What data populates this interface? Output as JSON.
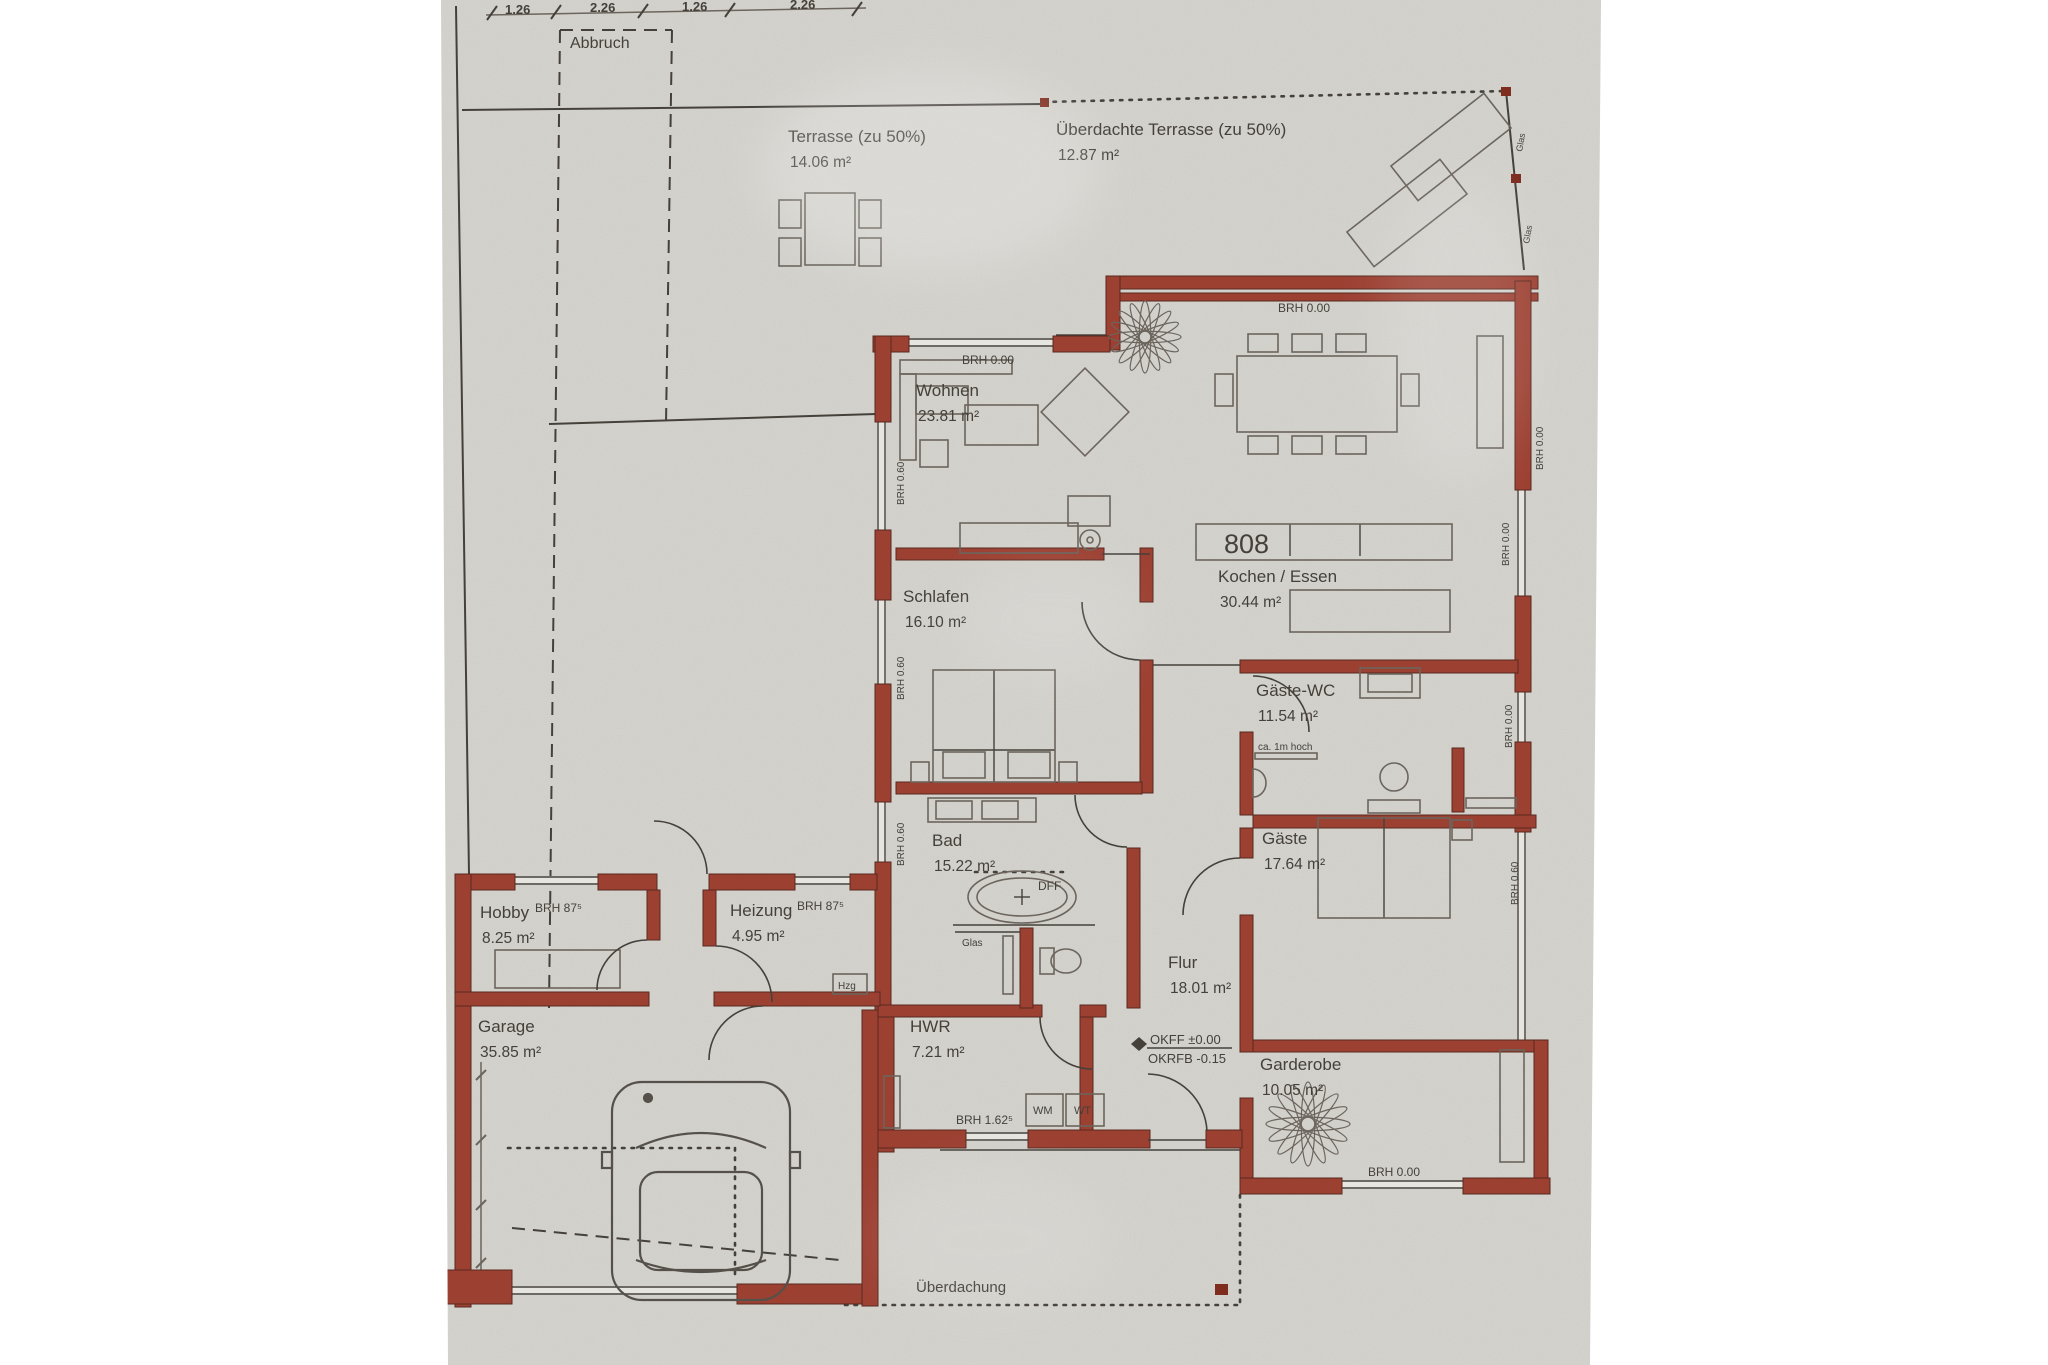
{
  "palette": {
    "paper": "#d4d2cc",
    "paper_light": "#e7e5e0",
    "wall_red": "#9c4032",
    "wall_stroke": "#58291f",
    "ink": "#45403a",
    "ink_soft": "#6b655d",
    "marker_red": "#7e2d1f",
    "white": "#ffffff"
  },
  "canvas": {
    "w": 2048,
    "h": 1365,
    "paper_poly": "441,0 1601,0 1590,1365 448,1365"
  },
  "dims": {
    "line": [
      486,
      15,
      866,
      8
    ],
    "ticks": [
      [
        492,
        13
      ],
      [
        556,
        12
      ],
      [
        643,
        11
      ],
      [
        730,
        10
      ],
      [
        857,
        9
      ]
    ],
    "labels": [
      {
        "t": "1.26",
        "x": 505,
        "y": 14
      },
      {
        "t": "2.26",
        "x": 590,
        "y": 12
      },
      {
        "t": "1.26",
        "x": 682,
        "y": 11
      },
      {
        "t": "2.26",
        "x": 790,
        "y": 9
      }
    ]
  },
  "rooms": [
    {
      "name": "terrasse",
      "label": "Terrasse (zu 50%)",
      "area": "14.06 m²",
      "x": 788,
      "y": 142
    },
    {
      "name": "ueberdachte-terrasse",
      "label": "Überdachte Terrasse (zu 50%)",
      "area": "12.87 m²",
      "x": 1056,
      "y": 135
    },
    {
      "name": "wohnen",
      "label": "Wohnen",
      "area": "23.81 m²",
      "x": 916,
      "y": 396
    },
    {
      "name": "kochen-essen",
      "label": "Kochen / Essen",
      "area": "30.44 m²",
      "x": 1218,
      "y": 582
    },
    {
      "name": "schlafen",
      "label": "Schlafen",
      "area": "16.10 m²",
      "x": 903,
      "y": 602
    },
    {
      "name": "gaeste-wc",
      "label": "Gäste-WC",
      "area": "11.54 m²",
      "x": 1256,
      "y": 696
    },
    {
      "name": "bad",
      "label": "Bad",
      "area": "15.22 m²",
      "x": 932,
      "y": 846
    },
    {
      "name": "gaeste",
      "label": "Gäste",
      "area": "17.64 m²",
      "x": 1262,
      "y": 844
    },
    {
      "name": "flur",
      "label": "Flur",
      "area": "18.01 m²",
      "x": 1168,
      "y": 968
    },
    {
      "name": "hobby",
      "label": "Hobby",
      "area": "8.25 m²",
      "x": 480,
      "y": 918
    },
    {
      "name": "heizung",
      "label": "Heizung",
      "area": "4.95 m²",
      "x": 730,
      "y": 916
    },
    {
      "name": "garage",
      "label": "Garage",
      "area": "35.85 m²",
      "x": 478,
      "y": 1032
    },
    {
      "name": "hwr",
      "label": "HWR",
      "area": "7.21 m²",
      "x": 910,
      "y": 1032
    },
    {
      "name": "garderobe",
      "label": "Garderobe",
      "area": "10.05 m²",
      "x": 1260,
      "y": 1070
    }
  ],
  "annotations": [
    {
      "t": "Abbruch",
      "x": 570,
      "y": 48,
      "fs": 16
    },
    {
      "t": "BRH 0.00",
      "x": 962,
      "y": 364,
      "fs": 12
    },
    {
      "t": "BRH 0.00",
      "x": 1278,
      "y": 312,
      "fs": 12
    },
    {
      "t": "BRH 87⁵",
      "x": 535,
      "y": 912,
      "fs": 12
    },
    {
      "t": "BRH 87⁵",
      "x": 797,
      "y": 910,
      "fs": 12
    },
    {
      "t": "ca. 1m hoch",
      "x": 1258,
      "y": 750,
      "fs": 10
    },
    {
      "t": "DFF",
      "x": 1038,
      "y": 890,
      "fs": 12
    },
    {
      "t": "Glas",
      "x": 962,
      "y": 946,
      "fs": 10
    },
    {
      "t": "OKFF  ±0.00",
      "x": 1150,
      "y": 1044,
      "fs": 13
    },
    {
      "t": "OKRFB -0.15",
      "x": 1148,
      "y": 1063,
      "fs": 13
    },
    {
      "t": "Hzg",
      "x": 838,
      "y": 989,
      "fs": 10
    },
    {
      "t": "WM",
      "x": 1033,
      "y": 1114,
      "fs": 11
    },
    {
      "t": "WT",
      "x": 1074,
      "y": 1114,
      "fs": 11
    },
    {
      "t": "BRH 1.62⁵",
      "x": 956,
      "y": 1124,
      "fs": 12
    },
    {
      "t": "BRH 0.00",
      "x": 1368,
      "y": 1176,
      "fs": 12
    },
    {
      "t": "Überdachung",
      "x": 916,
      "y": 1292,
      "fs": 15
    },
    {
      "t": "808",
      "x": 1224,
      "y": 553,
      "fs": 27
    },
    {
      "t": "BRH 0.60",
      "x": 904,
      "y": 505,
      "fs": 10,
      "rot": -90
    },
    {
      "t": "BRH 0.60",
      "x": 904,
      "y": 700,
      "fs": 10,
      "rot": -90
    },
    {
      "t": "BRH 0.60",
      "x": 904,
      "y": 866,
      "fs": 10,
      "rot": -90
    },
    {
      "t": "BRH 0.00",
      "x": 1509,
      "y": 566,
      "fs": 10,
      "rot": -90
    },
    {
      "t": "BRH 0.00",
      "x": 1543,
      "y": 470,
      "fs": 10,
      "rot": -90
    },
    {
      "t": "BRH 0.00",
      "x": 1512,
      "y": 748,
      "fs": 10,
      "rot": -90
    },
    {
      "t": "BRH 0.60",
      "x": 1518,
      "y": 905,
      "fs": 10,
      "rot": -90
    },
    {
      "t": "Glas",
      "x": 1522,
      "y": 152,
      "fs": 9,
      "rot": -80
    },
    {
      "t": "Glas",
      "x": 1529,
      "y": 244,
      "fs": 9,
      "rot": -80
    }
  ],
  "site": {
    "solid": [
      [
        462,
        110,
        1044,
        104
      ],
      [
        1506,
        91,
        1524,
        270
      ],
      [
        456,
        6,
        469,
        874
      ],
      [
        549,
        424,
        876,
        414
      ]
    ],
    "dashed": [
      [
        560,
        30,
        672,
        30
      ],
      [
        560,
        30,
        549,
        1008
      ],
      [
        672,
        30,
        666,
        424
      ],
      [
        512,
        1228,
        840,
        1260
      ]
    ],
    "dotted": [
      [
        1044,
        102,
        1506,
        91
      ],
      [
        1240,
        1195,
        1240,
        1307
      ],
      [
        845,
        1305,
        1240,
        1305
      ],
      [
        508,
        1148,
        735,
        1148
      ],
      [
        735,
        1148,
        735,
        1277
      ],
      [
        975,
        872,
        1070,
        872
      ]
    ],
    "markers": [
      [
        1040,
        98,
        9,
        9
      ],
      [
        1501,
        87,
        10,
        9
      ],
      [
        1511,
        174,
        10,
        9
      ],
      [
        1215,
        1284,
        13,
        11
      ]
    ],
    "chain": {
      "line": [
        481,
        1062,
        481,
        1272
      ],
      "ticks": [
        [
          476,
          1080,
          486,
          1070
        ],
        [
          476,
          1145,
          486,
          1135
        ],
        [
          476,
          1210,
          486,
          1200
        ],
        [
          476,
          1268,
          486,
          1258
        ]
      ]
    }
  },
  "walls": [
    [
      1118,
      276,
      420,
      13
    ],
    [
      1118,
      293,
      420,
      8
    ],
    [
      1106,
      276,
      14,
      74
    ],
    [
      873,
      336,
      36,
      16
    ],
    [
      1053,
      336,
      57,
      16
    ],
    [
      875,
      336,
      16,
      86
    ],
    [
      875,
      530,
      16,
      70
    ],
    [
      875,
      684,
      16,
      118
    ],
    [
      875,
      862,
      16,
      150
    ],
    [
      878,
      1010,
      16,
      142
    ],
    [
      1515,
      281,
      16,
      209
    ],
    [
      1515,
      596,
      16,
      96
    ],
    [
      1515,
      742,
      16,
      90
    ],
    [
      1253,
      1040,
      295,
      12
    ],
    [
      1534,
      1040,
      14,
      152
    ],
    [
      1240,
      1178,
      102,
      16
    ],
    [
      1463,
      1178,
      87,
      16
    ],
    [
      896,
      548,
      208,
      12
    ],
    [
      1140,
      548,
      13,
      54
    ],
    [
      1140,
      660,
      13,
      133
    ],
    [
      896,
      782,
      246,
      12
    ],
    [
      1127,
      848,
      13,
      160
    ],
    [
      878,
      1005,
      164,
      12
    ],
    [
      1080,
      1005,
      26,
      12
    ],
    [
      1080,
      1017,
      13,
      113
    ],
    [
      1240,
      660,
      278,
      13
    ],
    [
      1240,
      732,
      13,
      83
    ],
    [
      1253,
      815,
      283,
      13
    ],
    [
      1240,
      828,
      13,
      30
    ],
    [
      1240,
      915,
      13,
      137
    ],
    [
      1240,
      1098,
      13,
      80
    ],
    [
      455,
      874,
      60,
      16
    ],
    [
      598,
      874,
      59,
      16
    ],
    [
      709,
      874,
      86,
      16
    ],
    [
      850,
      874,
      27,
      16
    ],
    [
      455,
      874,
      16,
      433
    ],
    [
      455,
      992,
      194,
      14
    ],
    [
      714,
      992,
      166,
      14
    ],
    [
      647,
      890,
      13,
      50
    ],
    [
      703,
      890,
      13,
      56
    ],
    [
      447,
      1270,
      65,
      34
    ],
    [
      737,
      1284,
      125,
      20
    ],
    [
      862,
      1010,
      16,
      296
    ],
    [
      878,
      1130,
      88,
      18
    ],
    [
      1028,
      1130,
      122,
      18
    ],
    [
      1206,
      1130,
      36,
      18
    ],
    [
      1452,
      748,
      12,
      64
    ],
    [
      1020,
      928,
      13,
      80
    ]
  ],
  "windows": {
    "h": [
      [
        907,
        338,
        146
      ],
      [
        1056,
        334,
        50
      ],
      [
        515,
        876,
        83
      ],
      [
        793,
        876,
        57
      ],
      [
        493,
        996,
        127
      ],
      [
        966,
        1132,
        62
      ],
      [
        1340,
        1180,
        123
      ],
      [
        512,
        1286,
        225
      ]
    ],
    "v": [
      [
        877,
        420,
        110
      ],
      [
        877,
        598,
        86
      ],
      [
        877,
        800,
        62
      ],
      [
        1517,
        490,
        106
      ],
      [
        1517,
        692,
        50
      ],
      [
        1517,
        832,
        60
      ],
      [
        1517,
        892,
        148
      ]
    ]
  },
  "thin": [
    [
      1102,
      554,
      1150,
      554
    ],
    [
      1153,
      665,
      1240,
      665
    ],
    [
      994,
      670,
      994,
      782
    ],
    [
      933,
      750,
      1055,
      750
    ],
    [
      1384,
      818,
      1384,
      918
    ],
    [
      955,
      932,
      1020,
      932
    ],
    [
      1147,
      1048,
      1232,
      1048
    ],
    [
      940,
      1150,
      1240,
      1150
    ],
    [
      1148,
      1140,
      1206,
      1140
    ],
    [
      1290,
      524,
      1290,
      556
    ],
    [
      1360,
      524,
      1360,
      556
    ],
    [
      953,
      925,
      1095,
      925
    ],
    [
      1014,
      897,
      1030,
      897
    ],
    [
      1022,
      889,
      1022,
      905
    ]
  ],
  "doors": [
    "M707,874 A53,53 0 0 0 654,821",
    "M716,946 A56,56 0 0 1 772,1002",
    "M647,940 A50,50 0 0 0 597,990",
    "M709,1060 A54,54 0 0 1 763,1006",
    "M1082,602 A58,58 0 0 0 1140,660",
    "M1127,847 A52,52 0 0 1 1075,795",
    "M1040,1017 A52,52 0 0 0 1092,1069",
    "M1148,1074 A60,60 0 0 1 1207,1131",
    "M1253,676 A56,56 0 0 1 1309,732",
    "M1240,858 A57,57 0 0 0 1183,915"
  ],
  "furniture": {
    "rects": [
      [
        805,
        193,
        50,
        72
      ],
      [
        779,
        200,
        22,
        28
      ],
      [
        779,
        238,
        22,
        28
      ],
      [
        859,
        200,
        22,
        28
      ],
      [
        859,
        238,
        22,
        28
      ],
      [
        1237,
        356,
        160,
        76
      ],
      [
        1248,
        334,
        30,
        18
      ],
      [
        1292,
        334,
        30,
        18
      ],
      [
        1336,
        334,
        30,
        18
      ],
      [
        1248,
        436,
        30,
        18
      ],
      [
        1292,
        436,
        30,
        18
      ],
      [
        1336,
        436,
        30,
        18
      ],
      [
        1401,
        374,
        18,
        32
      ],
      [
        1215,
        374,
        18,
        32
      ],
      [
        1477,
        336,
        26,
        112
      ],
      [
        1196,
        524,
        256,
        36
      ],
      [
        1290,
        590,
        160,
        42
      ],
      [
        900,
        360,
        112,
        14
      ],
      [
        900,
        374,
        16,
        86
      ],
      [
        916,
        386,
        52,
        28
      ],
      [
        965,
        405,
        73,
        40
      ],
      [
        920,
        440,
        28,
        27
      ],
      [
        1068,
        496,
        42,
        30
      ],
      [
        960,
        523,
        118,
        30
      ],
      [
        933,
        670,
        122,
        112
      ],
      [
        911,
        762,
        18,
        20
      ],
      [
        1059,
        762,
        18,
        20
      ],
      [
        943,
        752,
        42,
        26
      ],
      [
        1008,
        752,
        42,
        26
      ],
      [
        928,
        798,
        108,
        24
      ],
      [
        936,
        801,
        36,
        18
      ],
      [
        982,
        801,
        36,
        18
      ],
      [
        1003,
        936,
        10,
        58
      ],
      [
        1040,
        948,
        14,
        26
      ],
      [
        1360,
        668,
        60,
        30
      ],
      [
        1368,
        674,
        44,
        18
      ],
      [
        1368,
        800,
        52,
        13
      ],
      [
        1466,
        798,
        50,
        10
      ],
      [
        1318,
        818,
        132,
        100
      ],
      [
        1452,
        820,
        20,
        20
      ],
      [
        1500,
        1050,
        24,
        112
      ],
      [
        1026,
        1094,
        37,
        32
      ],
      [
        1066,
        1094,
        38,
        32
      ],
      [
        884,
        1076,
        16,
        52
      ],
      [
        495,
        950,
        125,
        38
      ],
      [
        833,
        974,
        34,
        20
      ],
      [
        1255,
        753,
        62,
        6
      ]
    ],
    "ellipses": [
      [
        1022,
        897,
        54,
        26
      ],
      [
        1022,
        897,
        45,
        19
      ],
      [
        1066,
        961,
        15,
        12
      ]
    ],
    "circles": [
      [
        1090,
        540,
        10
      ],
      [
        1090,
        540,
        3
      ],
      [
        1394,
        777,
        14
      ]
    ],
    "paths": [
      "M1253,769 a13,14 0 0 1 0,28 Z"
    ],
    "rot": [
      {
        "x": 1085,
        "y": 412,
        "w": 62,
        "h": 62,
        "a": 45
      },
      {
        "x": 1451,
        "y": 147,
        "w": 118,
        "h": 44,
        "a": -38
      },
      {
        "x": 1407,
        "y": 213,
        "w": 118,
        "h": 44,
        "a": -38
      }
    ]
  },
  "plants": [
    [
      1145,
      337,
      36
    ],
    [
      1308,
      1124,
      42
    ]
  ],
  "car": {
    "x": 612,
    "y": 1082,
    "w": 178,
    "h": 218
  }
}
